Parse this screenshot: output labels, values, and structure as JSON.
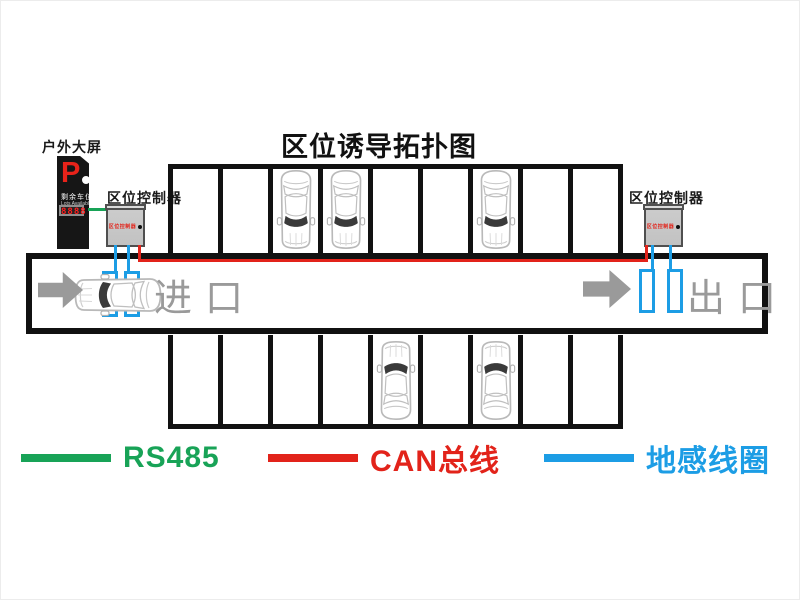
{
  "title": "区位诱导拓扑图",
  "outdoor_display": {
    "label": "户外大屏",
    "sign_letter": "P",
    "sign_line1": "剩余车位",
    "sign_line2": "Lots Available",
    "led_value": "8888"
  },
  "controllers": {
    "left": {
      "label": "区位控制器",
      "panel_text": "区位控制器"
    },
    "right": {
      "label": "区位控制器",
      "panel_text": "区位控制器"
    }
  },
  "lane": {
    "entrance_label": "进口",
    "exit_label": "出口"
  },
  "parking": {
    "top_row": {
      "stalls": 9,
      "occupied_stalls": [
        3,
        4,
        7
      ],
      "car_facing": "down"
    },
    "bottom_row": {
      "stalls": 9,
      "occupied_stalls": [
        5,
        7
      ],
      "car_facing": "up"
    }
  },
  "legend": {
    "items": [
      {
        "label": "RS485",
        "color": "#18a357"
      },
      {
        "label": "CAN总线",
        "color": "#e2231a"
      },
      {
        "label": "地感线圈",
        "color": "#1c9de5"
      }
    ]
  },
  "colors": {
    "wall": "#111111",
    "rs485_wire": "#18a357",
    "can_bus_wire": "#e2231a",
    "ground_loop": "#1c9de5",
    "lane_gray": "#9a9a9a",
    "sign_red": "#e8231a"
  }
}
